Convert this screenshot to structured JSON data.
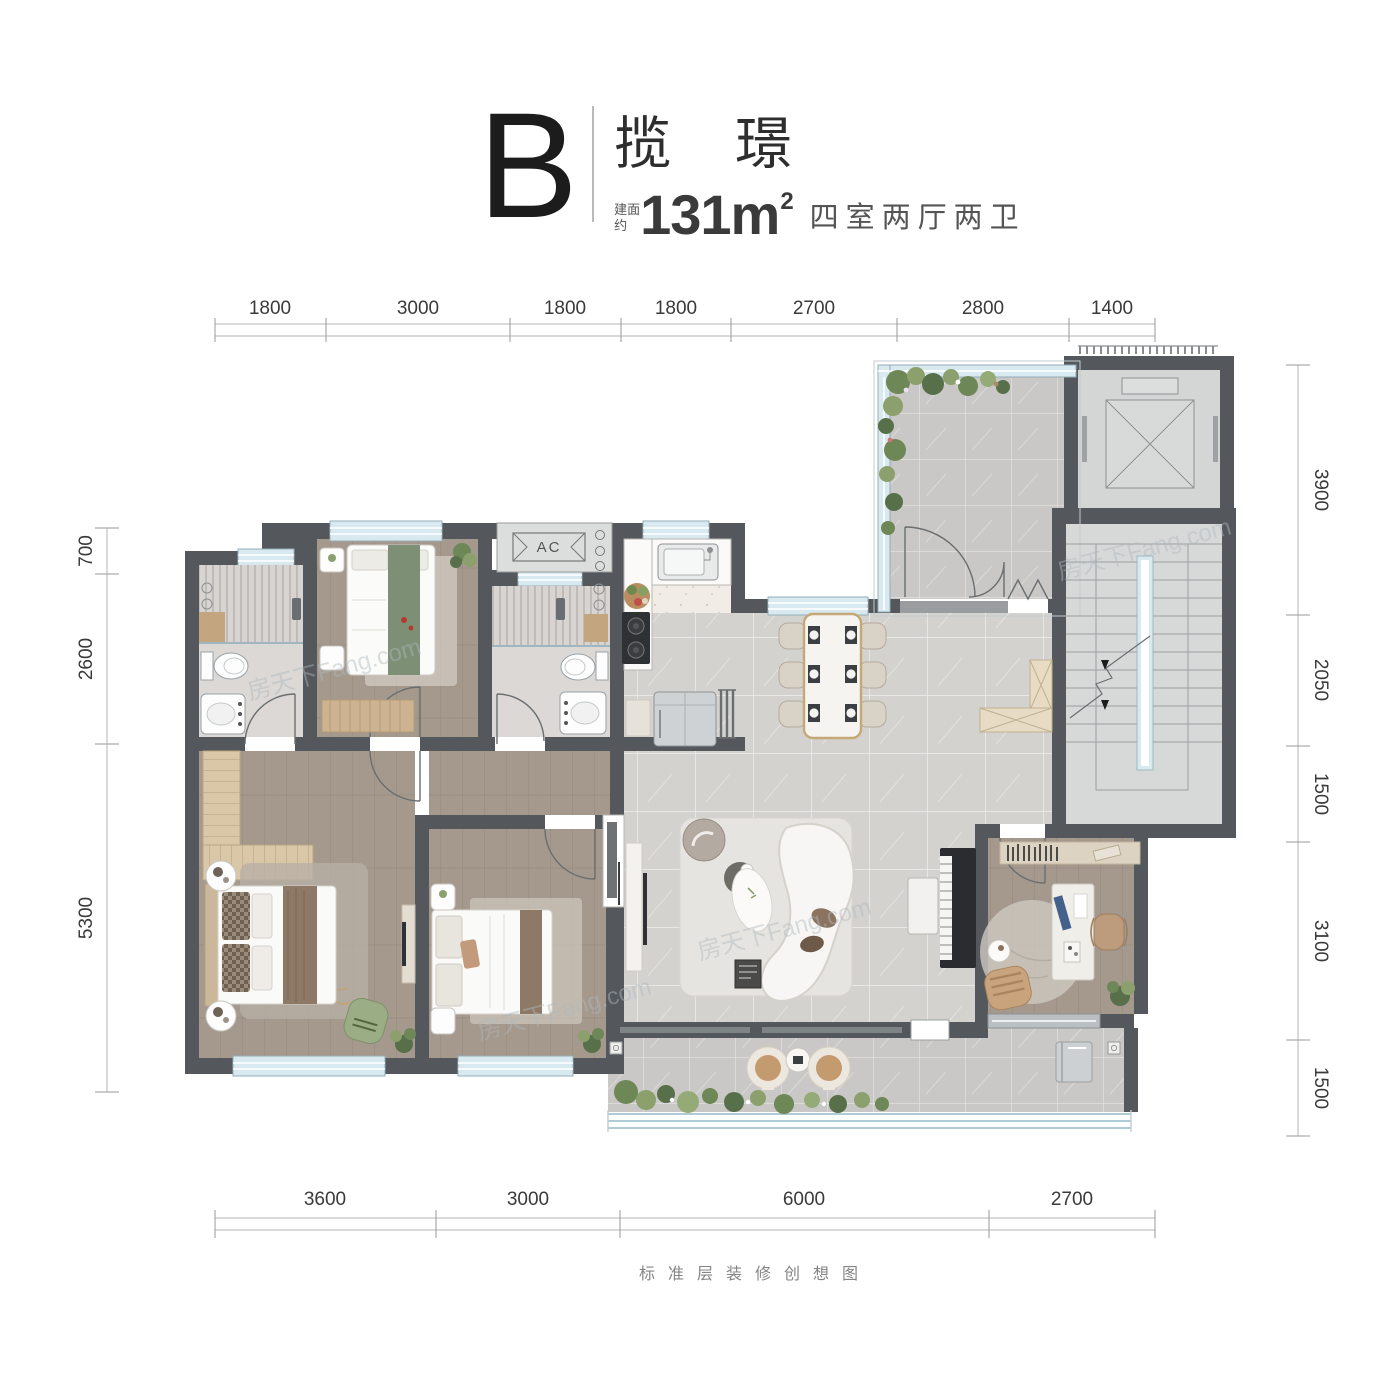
{
  "title": {
    "block_letter": "B",
    "name": "揽 璟",
    "area_label_line1": "建面",
    "area_label_line2": "约",
    "area_value": "131m",
    "area_superscript": "2",
    "rooms_summary": "四室两厅两卫"
  },
  "caption": "标准层装修创想图",
  "watermark": "房天下Fang.com",
  "labels": {
    "ac": "AC"
  },
  "dimensions": {
    "top": [
      "1800",
      "3000",
      "1800",
      "1800",
      "2700",
      "2800",
      "1400"
    ],
    "bottom": [
      "3600",
      "3000",
      "6000",
      "2700"
    ],
    "left": [
      "700",
      "2600",
      "5300"
    ],
    "right": [
      "3900",
      "2050",
      "1500",
      "3100",
      "1500"
    ]
  },
  "colors": {
    "wall": "#54585c",
    "window_glass": "#d9e9f0",
    "wood_floor": "#a5998d",
    "marble_floor": "#d4d2cf",
    "stone_floor": "#c9c8c6",
    "kitchen_floor": "#f1ede6",
    "bath_floor": "#dbd8d5",
    "cabinet_wood": "#d9c7a8",
    "accent_green": "#8ba06c",
    "accent_tan": "#c49a6f",
    "bedding_green": "#7d8f74",
    "runner_brown": "#8d7965",
    "dim_text": "#3a3a3a"
  }
}
